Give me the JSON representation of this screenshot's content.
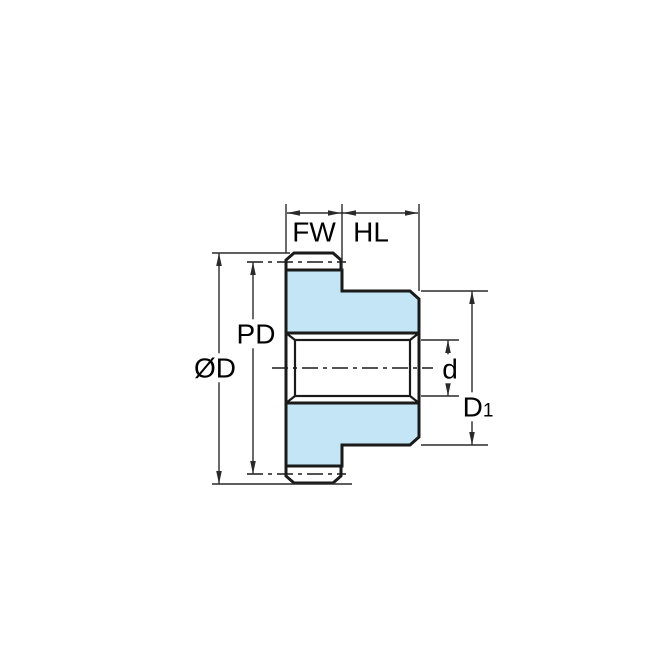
{
  "figure": {
    "type": "technical-drawing",
    "subject": "spur gear with hub, side cross-section view with dimension annotations",
    "labels": {
      "face_width": "FW",
      "hub_length": "HL",
      "pitch_diameter": "PD",
      "outside_diameter": "ØD",
      "bore_diameter": "d",
      "hub_diameter_main": "D",
      "hub_diameter_sub": "1"
    },
    "colors": {
      "part_fill": "#c3e5f5",
      "outline": "#1a1a1a",
      "dimension": "#2a2a2a",
      "background": "#ffffff"
    }
  }
}
